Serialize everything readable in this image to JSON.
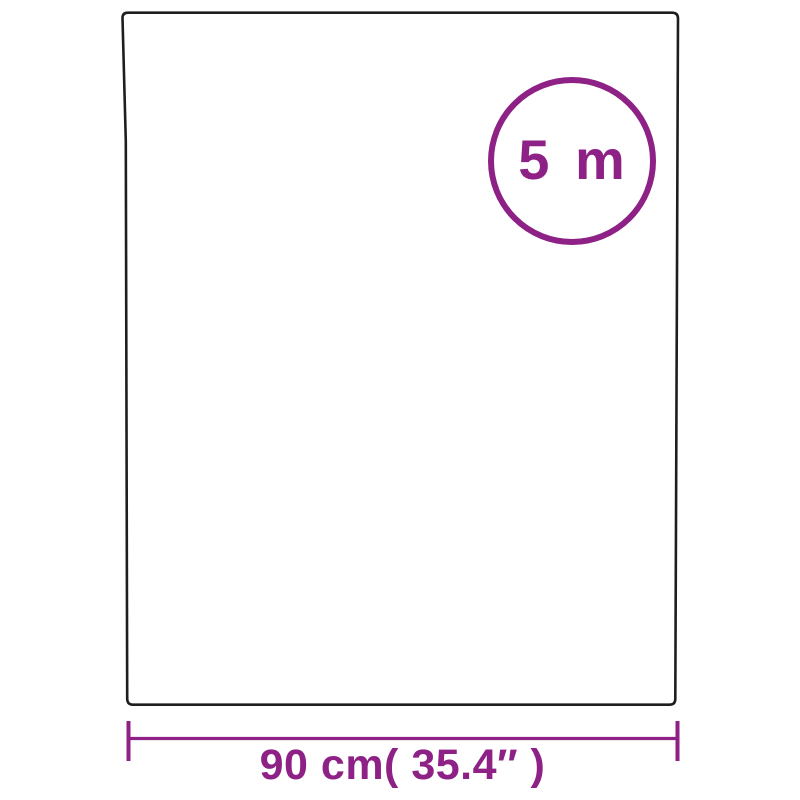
{
  "colors": {
    "accent": "#8E2186",
    "outline": "#1E1E1E",
    "background": "#FFFFFF"
  },
  "diagram": {
    "badge_label": "5 m",
    "width_label": "90 cm( 35.4″ )"
  }
}
